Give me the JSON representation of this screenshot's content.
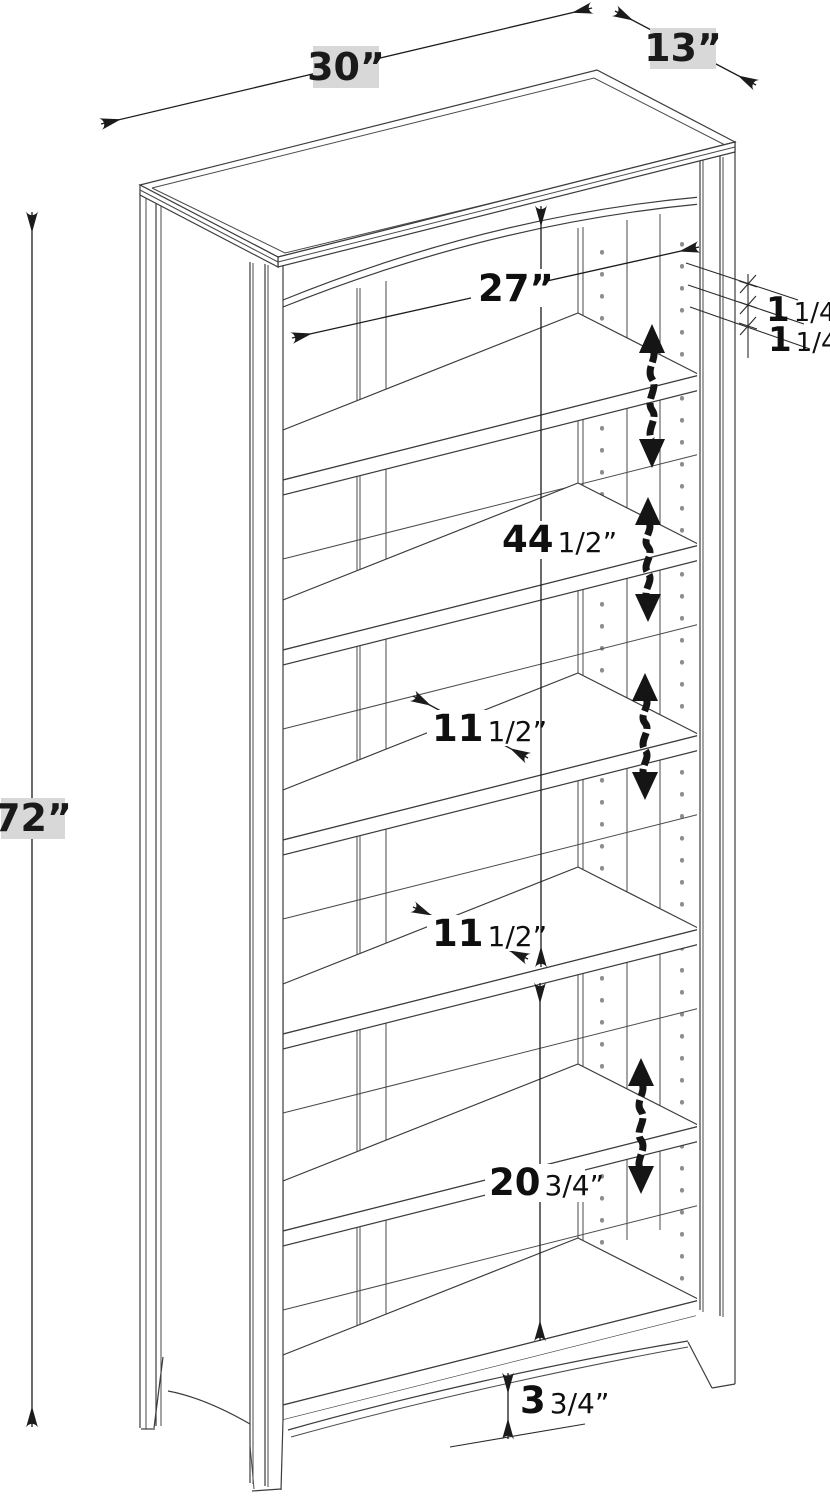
{
  "diagram": {
    "subject": "bookcase dimension drawing",
    "colors": {
      "line": "#3c3c3c",
      "annotation": "#151515",
      "label_bg": "#d8d8d8"
    },
    "dimensions": {
      "width": {
        "label": "30”",
        "whole": "30",
        "frac": ""
      },
      "depth": {
        "label": "13”",
        "whole": "13",
        "frac": ""
      },
      "height": {
        "label": "72”",
        "whole": "72",
        "frac": ""
      },
      "interior_width": {
        "label": "27”",
        "whole": "27",
        "frac": ""
      },
      "hole_spacing_a": {
        "label": "1 1/4”",
        "whole": "1",
        "frac": "1/4”"
      },
      "hole_spacing_b": {
        "label": "1 1/4”",
        "whole": "1",
        "frac": "1/4”"
      },
      "upper_opening_height": {
        "label": "44 1/2”",
        "whole": "44",
        "frac": "1/2”"
      },
      "shelf_depth_a": {
        "label": "11 1/2”",
        "whole": "11",
        "frac": "1/2”"
      },
      "shelf_depth_b": {
        "label": "11 1/2”",
        "whole": "11",
        "frac": "1/2”"
      },
      "lower_opening_height": {
        "label": "20 3/4”",
        "whole": "20",
        "frac": "3/4”"
      },
      "apron_height": {
        "label": "3 3/4”",
        "whole": "3",
        "frac": "3/4”"
      }
    }
  }
}
